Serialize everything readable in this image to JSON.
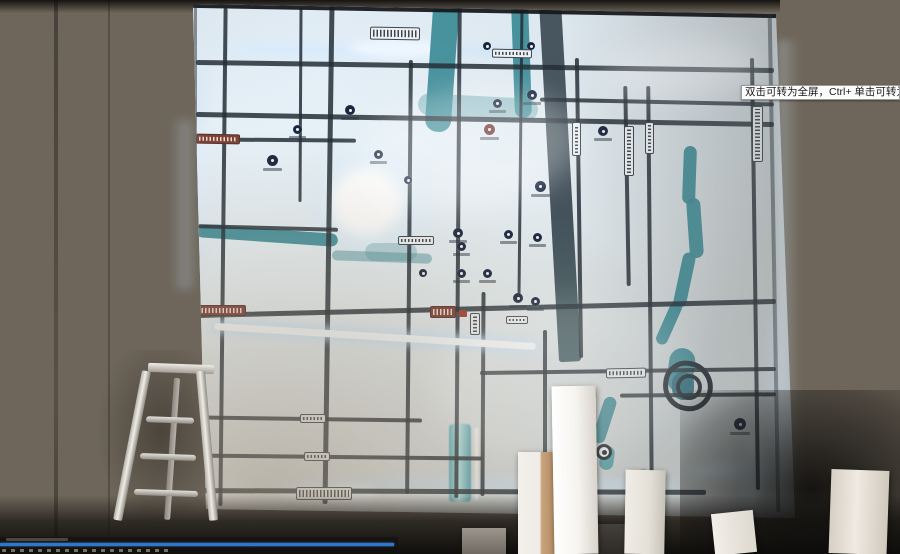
{
  "tooltip": {
    "text": "双击可转为全屏，Ctrl+ 单击可转为",
    "bg": "#fcfcfc",
    "text_color": "#1a1a1a"
  },
  "player": {
    "bar_color": "#2e77d0",
    "progress_percent": 99
  },
  "colors": {
    "wall_left": "#6a5f52",
    "wall_right": "#8a847a",
    "map_base": "#dde4e7",
    "road": "#242e36",
    "water": "#3f8d99",
    "water_bright": "#bdeef3",
    "glow": "#e6f2ff",
    "plate_bg": "#eef1f3",
    "plate_border": "#3c4650",
    "plate_maroon": "#7c4238",
    "icon_navy": "#1b2740",
    "icon_maroon": "#6e3434",
    "frame": "#16191c"
  },
  "map": {
    "roads_format": "[left,top,width,height,rotateDeg]",
    "roads_h": [
      [
        196,
        64,
        578,
        5,
        0.8
      ],
      [
        196,
        117,
        578,
        5,
        1.0
      ],
      [
        196,
        138,
        160,
        4,
        0.5
      ],
      [
        198,
        226,
        140,
        4,
        1.5
      ],
      [
        196,
        306,
        580,
        5,
        -1.4
      ],
      [
        480,
        369,
        296,
        4,
        -0.8
      ],
      [
        196,
        417,
        226,
        4,
        0.8
      ],
      [
        196,
        455,
        286,
        4,
        0.6
      ],
      [
        196,
        489,
        510,
        5,
        0.2
      ],
      [
        540,
        100,
        234,
        4,
        1.2
      ],
      [
        620,
        393,
        156,
        4,
        -0.5
      ]
    ],
    "roads_v": [
      [
        221,
        8,
        4,
        498,
        0.6
      ],
      [
        299,
        8,
        3,
        194,
        0.3
      ],
      [
        326,
        6,
        5,
        498,
        0.8
      ],
      [
        407,
        60,
        4,
        434,
        0.5
      ],
      [
        456,
        6,
        4,
        492,
        0.4
      ],
      [
        519,
        6,
        3,
        292,
        0.6
      ],
      [
        481,
        292,
        4,
        204,
        0.3
      ],
      [
        543,
        330,
        4,
        172,
        0
      ],
      [
        577,
        58,
        4,
        300,
        -0.8
      ],
      [
        625,
        86,
        4,
        200,
        -1.0
      ],
      [
        648,
        86,
        4,
        404,
        -0.5
      ],
      [
        753,
        58,
        4,
        432,
        -0.8
      ]
    ],
    "led_road": [
      214,
      333,
      322,
      7,
      3.6
    ],
    "band": [
      549,
      0,
      22,
      362,
      -3.2
    ],
    "rivers_format": "[left,top,width,height,rotateDeg,borderRadius,colorOverride?]",
    "rivers": [
      [
        429,
        0,
        26,
        132,
        4,
        12
      ],
      [
        513,
        0,
        17,
        118,
        -2,
        9
      ],
      [
        418,
        96,
        120,
        22,
        3,
        12,
        "rgba(78,150,160,0.45)"
      ],
      [
        196,
        229,
        142,
        13,
        4,
        8
      ],
      [
        332,
        252,
        100,
        10,
        2,
        8,
        "rgba(70,140,150,0.5)"
      ],
      [
        365,
        243,
        52,
        18,
        0,
        10,
        "rgba(80,150,160,0.35)"
      ],
      [
        683,
        146,
        13,
        58,
        2,
        7
      ],
      [
        688,
        198,
        14,
        60,
        -4,
        7
      ],
      [
        678,
        252,
        13,
        56,
        12,
        7
      ],
      [
        663,
        300,
        12,
        46,
        24,
        7
      ],
      [
        668,
        348,
        26,
        44,
        8,
        14
      ],
      [
        672,
        372,
        22,
        28,
        0,
        14,
        "#2f6f80"
      ],
      [
        598,
        396,
        13,
        48,
        18,
        7
      ],
      [
        600,
        446,
        14,
        24,
        8,
        7,
        "#58a5ae"
      ],
      [
        636,
        468,
        10,
        20,
        30,
        6,
        "rgba(90,170,178,0.6)"
      ]
    ],
    "water_strip": {
      "rect": [
        449,
        424,
        22,
        78
      ],
      "line": [
        475,
        428,
        3,
        72
      ]
    },
    "glows_format": "[left,top,width,height,rotateDeg,blurPx,color]",
    "glows": [
      [
        310,
        150,
        120,
        110,
        0,
        10,
        "rgba(220,240,255,0.55)"
      ],
      [
        330,
        168,
        72,
        68,
        0,
        7,
        "#ffffff"
      ],
      [
        214,
        44,
        240,
        13,
        1,
        4,
        "rgba(215,235,255,0.8)"
      ],
      [
        350,
        40,
        100,
        17,
        1,
        4,
        "#eef7ff"
      ],
      [
        456,
        46,
        90,
        11,
        1,
        4,
        "rgba(200,225,250,0.55)"
      ],
      [
        193,
        140,
        16,
        130,
        0,
        5,
        "rgba(225,240,255,0.75)"
      ],
      [
        193,
        60,
        12,
        70,
        0,
        5,
        "rgba(210,230,250,0.5)"
      ],
      [
        264,
        478,
        420,
        16,
        0,
        5,
        "rgba(210,235,255,0.65)"
      ],
      [
        280,
        486,
        70,
        14,
        0,
        4,
        "#e8f4ff"
      ],
      [
        330,
        483,
        48,
        18,
        0,
        4,
        "rgba(235,248,255,0.9)"
      ],
      [
        745,
        432,
        16,
        90,
        0,
        5,
        "rgba(230,245,255,0.95)"
      ],
      [
        692,
        462,
        100,
        16,
        -2,
        5,
        "rgba(225,242,255,0.85)"
      ],
      [
        764,
        496,
        30,
        22,
        0,
        6,
        "#dff0ff"
      ],
      [
        768,
        300,
        12,
        190,
        0,
        5,
        "rgba(220,238,255,0.5)"
      ]
    ],
    "sheens": [
      [
        360,
        90,
        220,
        120,
        -8,
        14,
        "rgba(255,255,255,0.30)"
      ],
      [
        600,
        40,
        160,
        60,
        -5,
        12,
        "rgba(255,255,255,0.22)"
      ],
      [
        430,
        300,
        260,
        160,
        -6,
        16,
        "rgba(255,255,255,0.14)"
      ]
    ],
    "plates_format": "[left,top,width,height,rotateDeg,isVertical,maroon?]",
    "plates": [
      [
        370,
        27,
        50,
        13,
        1,
        0
      ],
      [
        196,
        134,
        44,
        10,
        1,
        0,
        1
      ],
      [
        188,
        305,
        58,
        11,
        0,
        0,
        1
      ],
      [
        430,
        306,
        26,
        12,
        0,
        0,
        1
      ],
      [
        470,
        313,
        10,
        22,
        0,
        1
      ],
      [
        296,
        487,
        56,
        13,
        0,
        0
      ],
      [
        304,
        452,
        26,
        9,
        0,
        0
      ],
      [
        300,
        414,
        26,
        9,
        0,
        0
      ],
      [
        606,
        368,
        40,
        10,
        -1,
        0
      ],
      [
        752,
        106,
        11,
        56,
        0,
        1
      ],
      [
        572,
        122,
        9,
        34,
        0,
        1
      ],
      [
        624,
        126,
        10,
        50,
        0,
        1
      ],
      [
        645,
        122,
        9,
        32,
        0,
        1
      ],
      [
        492,
        49,
        40,
        9,
        1,
        0
      ],
      [
        398,
        236,
        36,
        9,
        0,
        0
      ],
      [
        506,
        316,
        22,
        8,
        0,
        0
      ]
    ],
    "marker_red": [
      459,
      310,
      8,
      7
    ],
    "icons_format": "[centerX,centerY,diameter,type]",
    "icons": [
      [
        272,
        160,
        11,
        "navy"
      ],
      [
        297,
        129,
        9,
        "navy"
      ],
      [
        350,
        110,
        10,
        "navy"
      ],
      [
        378,
        154,
        9,
        "navy"
      ],
      [
        408,
        180,
        8,
        "navy"
      ],
      [
        458,
        233,
        10,
        "navy"
      ],
      [
        489,
        129,
        11,
        "maroon"
      ],
      [
        497,
        103,
        9,
        "navy"
      ],
      [
        532,
        95,
        10,
        "navy"
      ],
      [
        540,
        186,
        11,
        "navy"
      ],
      [
        603,
        131,
        10,
        "navy"
      ],
      [
        518,
        298,
        10,
        "navy"
      ],
      [
        487,
        273,
        9,
        "navy"
      ],
      [
        461,
        246,
        9,
        "navy"
      ],
      [
        508,
        234,
        9,
        "navy"
      ],
      [
        537,
        237,
        9,
        "navy"
      ],
      [
        461,
        273,
        9,
        "navy"
      ],
      [
        423,
        273,
        8,
        "navy"
      ],
      [
        535,
        301,
        9,
        "navy"
      ],
      [
        740,
        424,
        12,
        "navy"
      ],
      [
        604,
        452,
        16,
        "station"
      ],
      [
        487,
        46,
        8,
        "pin"
      ],
      [
        531,
        46,
        8,
        "pin"
      ]
    ],
    "ring": {
      "outer": [
        663,
        361,
        50,
        50,
        8
      ],
      "inner": [
        676,
        374,
        26,
        26,
        0
      ],
      "border_color": "#242e36"
    }
  },
  "foreground": {
    "columns_format": "[left,top,width,height,rotateDeg,gradientCss]",
    "columns": [
      [
        462,
        528,
        44,
        26,
        0,
        "linear-gradient(180deg,#9b968d 0%,#6f6a62 100%)"
      ],
      [
        595,
        524,
        38,
        30,
        0,
        "linear-gradient(180deg,#44403a 0%,#2e2b27 100%)"
      ],
      [
        518,
        452,
        42,
        102,
        0,
        "linear-gradient(90deg,#f3f0ea 0%,#efece7 52%,#c9a37a 56%,#a9835c 100%)"
      ],
      [
        553,
        386,
        44,
        168,
        -1,
        "linear-gradient(90deg,#ffffff 0%,#f6f4ef 55%,#d8d4cc 100%)"
      ],
      [
        625,
        470,
        40,
        84,
        1,
        "linear-gradient(90deg,#f0ede6 0%,#e4e0d8 60%,#c8c3b9 100%)"
      ],
      [
        713,
        512,
        42,
        42,
        -6,
        "linear-gradient(90deg,#f2efe9 0%,#ddd8cf 100%)"
      ],
      [
        830,
        470,
        58,
        84,
        2,
        "linear-gradient(90deg,#d6cfc4 0%,#efeae2 45%,#cfc8bc 100%)"
      ]
    ]
  }
}
